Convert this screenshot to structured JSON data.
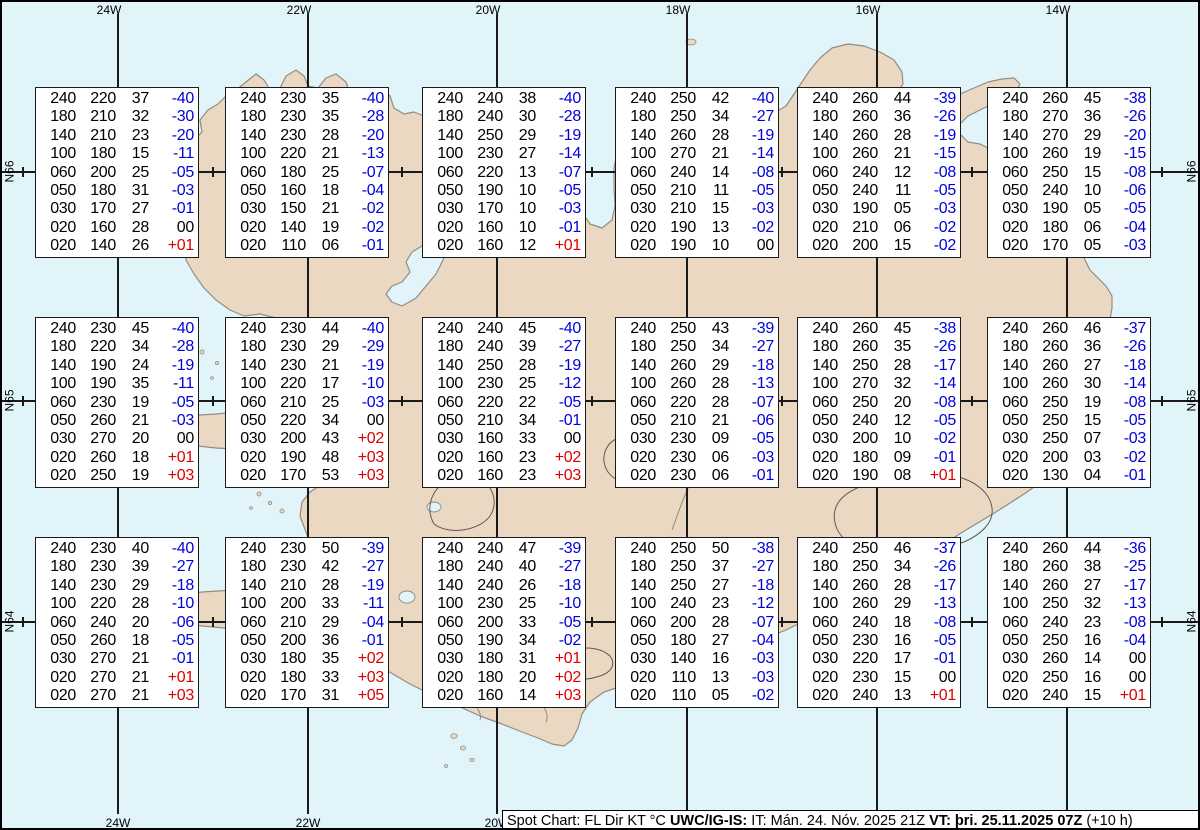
{
  "grid": {
    "lon_labels_top": [
      "24W",
      "22W",
      "20W",
      "18W",
      "16W",
      "14W"
    ],
    "lon_labels_bottom": [
      "24W",
      "22W",
      "20W"
    ],
    "lat_labels": [
      "N66",
      "N65",
      "N64"
    ]
  },
  "caption": {
    "legend": "Spot Chart: FL Dir KT °C ",
    "source": "UWC/IG-IS:",
    "issue": " IT: Mán. 24. Nóv. 2025 21Z ",
    "valid": "VT: þri. 25.11.2025 07Z",
    "offset": " (+10 h)"
  },
  "columns_meaning": [
    "FL",
    "Dir",
    "KT",
    "°C"
  ],
  "colors": {
    "ocean": "#e1f4f9",
    "land": "#ead8c3",
    "coast": "#918d82",
    "temp_negative": "#0000dd",
    "temp_positive": "#dd0000",
    "temp_zero": "#000000"
  },
  "stations": [
    {
      "row": 0,
      "col": 0,
      "values": [
        [
          "240",
          "220",
          "37",
          "-40"
        ],
        [
          "180",
          "210",
          "32",
          "-30"
        ],
        [
          "140",
          "210",
          "23",
          "-20"
        ],
        [
          "100",
          "180",
          "15",
          "-11"
        ],
        [
          "060",
          "200",
          "25",
          "-05"
        ],
        [
          "050",
          "180",
          "31",
          "-03"
        ],
        [
          "030",
          "170",
          "27",
          "-01"
        ],
        [
          "020",
          "160",
          "28",
          "00"
        ],
        [
          "020",
          "140",
          "26",
          "+01"
        ]
      ]
    },
    {
      "row": 0,
      "col": 1,
      "values": [
        [
          "240",
          "230",
          "35",
          "-40"
        ],
        [
          "180",
          "230",
          "35",
          "-28"
        ],
        [
          "140",
          "230",
          "28",
          "-20"
        ],
        [
          "100",
          "220",
          "21",
          "-13"
        ],
        [
          "060",
          "180",
          "25",
          "-07"
        ],
        [
          "050",
          "160",
          "18",
          "-04"
        ],
        [
          "030",
          "150",
          "21",
          "-02"
        ],
        [
          "020",
          "140",
          "19",
          "-02"
        ],
        [
          "020",
          "110",
          "06",
          "-01"
        ]
      ]
    },
    {
      "row": 0,
      "col": 2,
      "values": [
        [
          "240",
          "240",
          "38",
          "-40"
        ],
        [
          "180",
          "240",
          "30",
          "-28"
        ],
        [
          "140",
          "250",
          "29",
          "-19"
        ],
        [
          "100",
          "230",
          "27",
          "-14"
        ],
        [
          "060",
          "220",
          "13",
          "-07"
        ],
        [
          "050",
          "190",
          "10",
          "-05"
        ],
        [
          "030",
          "170",
          "10",
          "-03"
        ],
        [
          "020",
          "160",
          "10",
          "-01"
        ],
        [
          "020",
          "160",
          "12",
          "+01"
        ]
      ]
    },
    {
      "row": 0,
      "col": 3,
      "values": [
        [
          "240",
          "250",
          "42",
          "-40"
        ],
        [
          "180",
          "250",
          "34",
          "-27"
        ],
        [
          "140",
          "260",
          "28",
          "-19"
        ],
        [
          "100",
          "270",
          "21",
          "-14"
        ],
        [
          "060",
          "240",
          "14",
          "-08"
        ],
        [
          "050",
          "210",
          "11",
          "-05"
        ],
        [
          "030",
          "210",
          "15",
          "-03"
        ],
        [
          "020",
          "190",
          "13",
          "-02"
        ],
        [
          "020",
          "190",
          "10",
          "00"
        ]
      ]
    },
    {
      "row": 0,
      "col": 4,
      "values": [
        [
          "240",
          "260",
          "44",
          "-39"
        ],
        [
          "180",
          "260",
          "36",
          "-26"
        ],
        [
          "140",
          "260",
          "28",
          "-19"
        ],
        [
          "100",
          "260",
          "21",
          "-15"
        ],
        [
          "060",
          "240",
          "12",
          "-08"
        ],
        [
          "050",
          "240",
          "11",
          "-05"
        ],
        [
          "030",
          "190",
          "05",
          "-03"
        ],
        [
          "020",
          "210",
          "06",
          "-02"
        ],
        [
          "020",
          "200",
          "15",
          "-02"
        ]
      ]
    },
    {
      "row": 0,
      "col": 5,
      "values": [
        [
          "240",
          "260",
          "45",
          "-38"
        ],
        [
          "180",
          "270",
          "36",
          "-26"
        ],
        [
          "140",
          "270",
          "29",
          "-20"
        ],
        [
          "100",
          "260",
          "19",
          "-15"
        ],
        [
          "060",
          "250",
          "15",
          "-08"
        ],
        [
          "050",
          "240",
          "10",
          "-06"
        ],
        [
          "030",
          "190",
          "05",
          "-05"
        ],
        [
          "020",
          "180",
          "06",
          "-04"
        ],
        [
          "020",
          "170",
          "05",
          "-03"
        ]
      ]
    },
    {
      "row": 1,
      "col": 0,
      "values": [
        [
          "240",
          "230",
          "45",
          "-40"
        ],
        [
          "180",
          "220",
          "34",
          "-28"
        ],
        [
          "140",
          "190",
          "24",
          "-19"
        ],
        [
          "100",
          "190",
          "35",
          "-11"
        ],
        [
          "060",
          "230",
          "19",
          "-05"
        ],
        [
          "050",
          "260",
          "21",
          "-03"
        ],
        [
          "030",
          "270",
          "20",
          "00"
        ],
        [
          "020",
          "260",
          "18",
          "+01"
        ],
        [
          "020",
          "250",
          "19",
          "+03"
        ]
      ]
    },
    {
      "row": 1,
      "col": 1,
      "values": [
        [
          "240",
          "230",
          "44",
          "-40"
        ],
        [
          "180",
          "230",
          "29",
          "-29"
        ],
        [
          "140",
          "230",
          "21",
          "-19"
        ],
        [
          "100",
          "220",
          "17",
          "-10"
        ],
        [
          "060",
          "210",
          "25",
          "-03"
        ],
        [
          "050",
          "220",
          "34",
          "00"
        ],
        [
          "030",
          "200",
          "43",
          "+02"
        ],
        [
          "020",
          "190",
          "48",
          "+03"
        ],
        [
          "020",
          "170",
          "53",
          "+03"
        ]
      ]
    },
    {
      "row": 1,
      "col": 2,
      "values": [
        [
          "240",
          "240",
          "45",
          "-40"
        ],
        [
          "180",
          "240",
          "39",
          "-27"
        ],
        [
          "140",
          "250",
          "28",
          "-19"
        ],
        [
          "100",
          "230",
          "25",
          "-12"
        ],
        [
          "060",
          "220",
          "22",
          "-05"
        ],
        [
          "050",
          "210",
          "34",
          "-01"
        ],
        [
          "030",
          "160",
          "33",
          "00"
        ],
        [
          "020",
          "160",
          "23",
          "+02"
        ],
        [
          "020",
          "160",
          "23",
          "+03"
        ]
      ]
    },
    {
      "row": 1,
      "col": 3,
      "values": [
        [
          "240",
          "250",
          "43",
          "-39"
        ],
        [
          "180",
          "250",
          "34",
          "-27"
        ],
        [
          "140",
          "260",
          "29",
          "-18"
        ],
        [
          "100",
          "260",
          "28",
          "-13"
        ],
        [
          "060",
          "220",
          "28",
          "-07"
        ],
        [
          "050",
          "210",
          "21",
          "-06"
        ],
        [
          "030",
          "230",
          "09",
          "-05"
        ],
        [
          "020",
          "230",
          "06",
          "-03"
        ],
        [
          "020",
          "230",
          "06",
          "-01"
        ]
      ]
    },
    {
      "row": 1,
      "col": 4,
      "values": [
        [
          "240",
          "260",
          "45",
          "-38"
        ],
        [
          "180",
          "260",
          "35",
          "-26"
        ],
        [
          "140",
          "250",
          "28",
          "-17"
        ],
        [
          "100",
          "270",
          "32",
          "-14"
        ],
        [
          "060",
          "250",
          "20",
          "-08"
        ],
        [
          "050",
          "240",
          "12",
          "-05"
        ],
        [
          "030",
          "200",
          "10",
          "-02"
        ],
        [
          "020",
          "180",
          "09",
          "-01"
        ],
        [
          "020",
          "190",
          "08",
          "+01"
        ]
      ]
    },
    {
      "row": 1,
      "col": 5,
      "values": [
        [
          "240",
          "260",
          "46",
          "-37"
        ],
        [
          "180",
          "260",
          "36",
          "-26"
        ],
        [
          "140",
          "260",
          "27",
          "-18"
        ],
        [
          "100",
          "260",
          "30",
          "-14"
        ],
        [
          "060",
          "250",
          "19",
          "-08"
        ],
        [
          "050",
          "250",
          "15",
          "-05"
        ],
        [
          "030",
          "250",
          "07",
          "-03"
        ],
        [
          "020",
          "200",
          "03",
          "-02"
        ],
        [
          "020",
          "130",
          "04",
          "-01"
        ]
      ]
    },
    {
      "row": 2,
      "col": 0,
      "values": [
        [
          "240",
          "230",
          "40",
          "-40"
        ],
        [
          "180",
          "230",
          "39",
          "-27"
        ],
        [
          "140",
          "230",
          "29",
          "-18"
        ],
        [
          "100",
          "220",
          "28",
          "-10"
        ],
        [
          "060",
          "240",
          "20",
          "-06"
        ],
        [
          "050",
          "260",
          "18",
          "-05"
        ],
        [
          "030",
          "270",
          "21",
          "-01"
        ],
        [
          "020",
          "270",
          "21",
          "+01"
        ],
        [
          "020",
          "270",
          "21",
          "+03"
        ]
      ]
    },
    {
      "row": 2,
      "col": 1,
      "values": [
        [
          "240",
          "230",
          "50",
          "-39"
        ],
        [
          "180",
          "230",
          "42",
          "-27"
        ],
        [
          "140",
          "210",
          "28",
          "-19"
        ],
        [
          "100",
          "200",
          "33",
          "-11"
        ],
        [
          "060",
          "210",
          "29",
          "-04"
        ],
        [
          "050",
          "200",
          "36",
          "-01"
        ],
        [
          "030",
          "180",
          "35",
          "+02"
        ],
        [
          "020",
          "180",
          "33",
          "+03"
        ],
        [
          "020",
          "170",
          "31",
          "+05"
        ]
      ]
    },
    {
      "row": 2,
      "col": 2,
      "values": [
        [
          "240",
          "240",
          "47",
          "-39"
        ],
        [
          "180",
          "240",
          "40",
          "-27"
        ],
        [
          "140",
          "240",
          "26",
          "-18"
        ],
        [
          "100",
          "230",
          "25",
          "-10"
        ],
        [
          "060",
          "200",
          "33",
          "-05"
        ],
        [
          "050",
          "190",
          "34",
          "-02"
        ],
        [
          "030",
          "180",
          "31",
          "+01"
        ],
        [
          "020",
          "180",
          "20",
          "+02"
        ],
        [
          "020",
          "160",
          "14",
          "+03"
        ]
      ]
    },
    {
      "row": 2,
      "col": 3,
      "values": [
        [
          "240",
          "250",
          "50",
          "-38"
        ],
        [
          "180",
          "250",
          "37",
          "-27"
        ],
        [
          "140",
          "250",
          "27",
          "-18"
        ],
        [
          "100",
          "240",
          "23",
          "-12"
        ],
        [
          "060",
          "200",
          "28",
          "-07"
        ],
        [
          "050",
          "180",
          "27",
          "-04"
        ],
        [
          "030",
          "140",
          "16",
          "-03"
        ],
        [
          "020",
          "110",
          "13",
          "-03"
        ],
        [
          "020",
          "110",
          "05",
          "-02"
        ]
      ]
    },
    {
      "row": 2,
      "col": 4,
      "values": [
        [
          "240",
          "250",
          "46",
          "-37"
        ],
        [
          "180",
          "250",
          "34",
          "-26"
        ],
        [
          "140",
          "260",
          "28",
          "-17"
        ],
        [
          "100",
          "260",
          "29",
          "-13"
        ],
        [
          "060",
          "240",
          "18",
          "-08"
        ],
        [
          "050",
          "230",
          "16",
          "-05"
        ],
        [
          "030",
          "220",
          "17",
          "-01"
        ],
        [
          "020",
          "230",
          "15",
          "00"
        ],
        [
          "020",
          "240",
          "13",
          "+01"
        ]
      ]
    },
    {
      "row": 2,
      "col": 5,
      "values": [
        [
          "240",
          "260",
          "44",
          "-36"
        ],
        [
          "180",
          "260",
          "38",
          "-25"
        ],
        [
          "140",
          "260",
          "27",
          "-17"
        ],
        [
          "100",
          "250",
          "32",
          "-13"
        ],
        [
          "060",
          "240",
          "23",
          "-08"
        ],
        [
          "050",
          "250",
          "16",
          "-04"
        ],
        [
          "030",
          "260",
          "14",
          "00"
        ],
        [
          "020",
          "250",
          "16",
          "00"
        ],
        [
          "020",
          "240",
          "15",
          "+01"
        ]
      ]
    }
  ]
}
